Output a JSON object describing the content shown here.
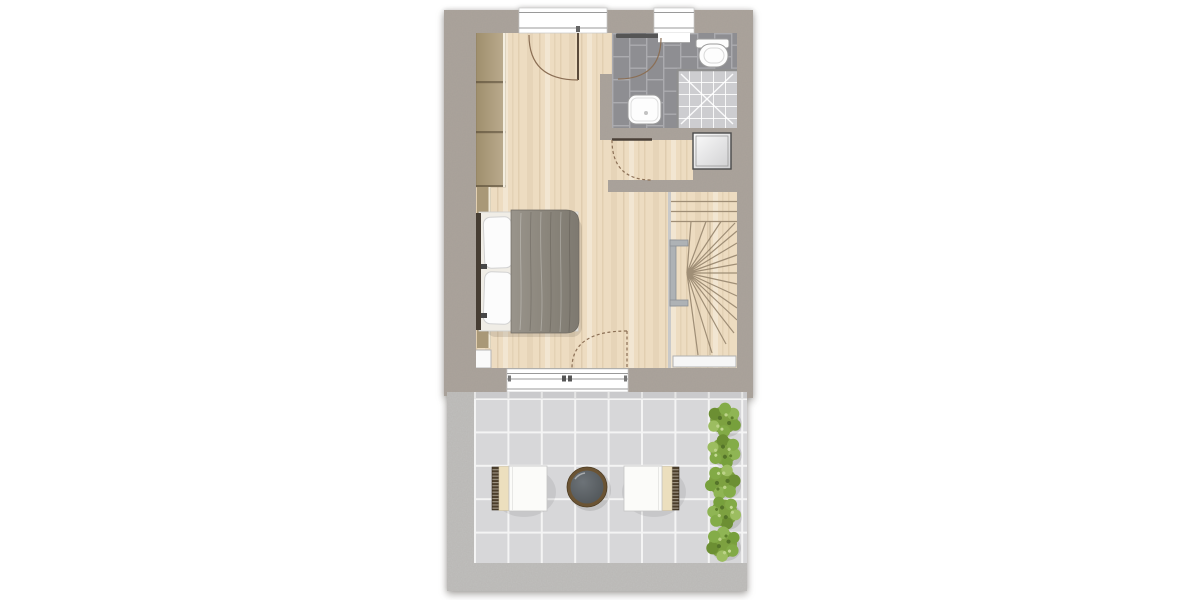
{
  "scene": {
    "type": "architectural-floor-plan-top-view",
    "rooms": [
      "bedroom",
      "bathroom",
      "hallway",
      "winder-staircase",
      "terrace"
    ],
    "furniture": [
      "built-in-wardrobe",
      "double-bed",
      "toilet",
      "washbasin",
      "shower",
      "washing-machine",
      "terrace-chair-left",
      "terrace-chair-right",
      "round-table",
      "bush-row"
    ],
    "openings": [
      "french-window-top",
      "bathroom-window",
      "bathroom-door",
      "hallway-door",
      "terrace-sliding-door"
    ],
    "bush_count": 5
  },
  "colors": {
    "wall": "#aba39b",
    "wood": "#eddcc1",
    "stairWood": "#ecdcbe",
    "bathTile": "#8e8e92",
    "bathGrout": "#ababaf",
    "shower": "#cdcdd0",
    "terraceTile": "#d7d7d9",
    "terraceGrout": "#f4f4f4",
    "terraceBorder": "#c0bfbd",
    "duvet": "#8c877d",
    "pillow": "#fcfcfc",
    "wardrobe": "#b0a082",
    "cushion": "#ecdfbe",
    "chairBack": "#4c3e2b",
    "tableTop": "#565b5f",
    "tableRim": "#6b5434",
    "bush": "#7da140",
    "doorArc": "#8b6f55",
    "tread": "#9f8e76",
    "fixture": "#9c9c9c",
    "glass": "#8f8f8f"
  }
}
